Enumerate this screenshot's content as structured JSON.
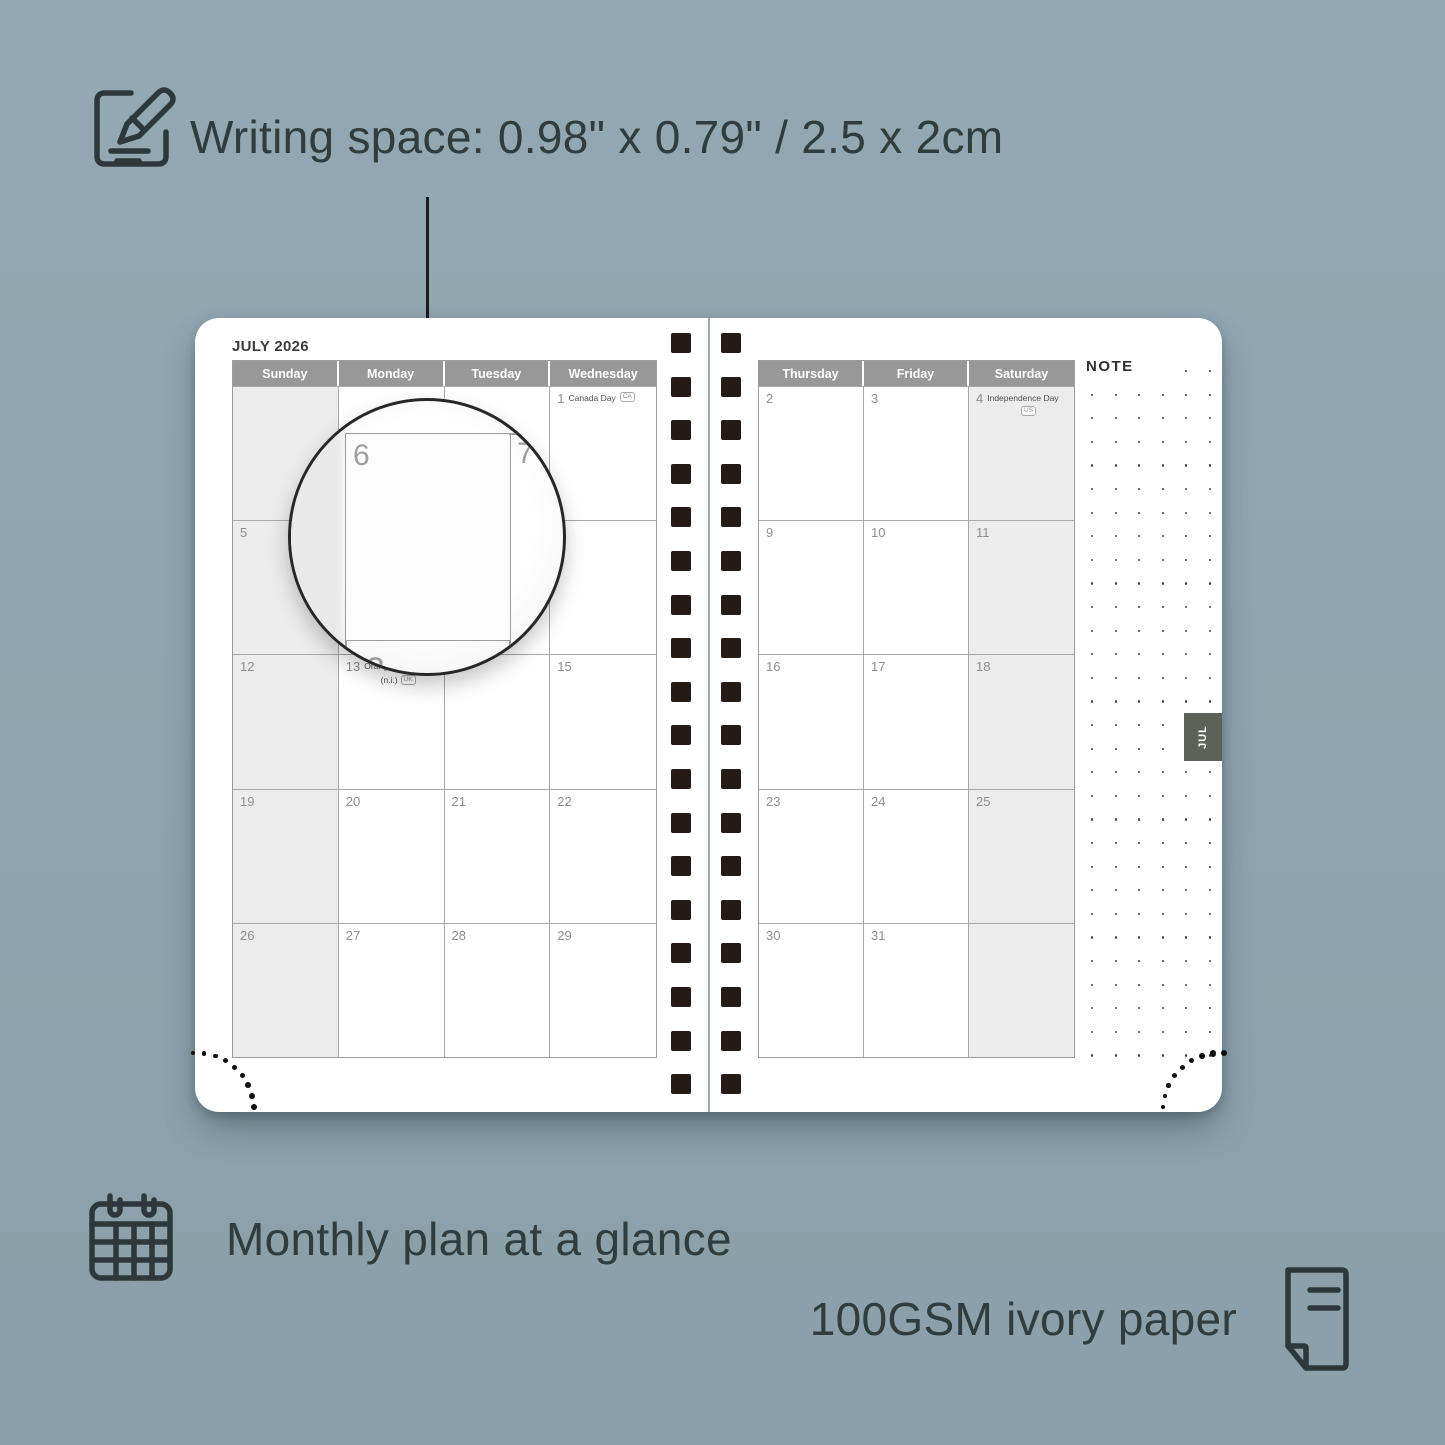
{
  "annotations": {
    "writing_space": "Writing space: 0.98\" x 0.79\" / 2.5 x 2cm",
    "monthly_plan": "Monthly plan at a glance",
    "paper": "100GSM ivory paper"
  },
  "planner": {
    "title": "JULY 2026",
    "note_label": "NOTE",
    "month_tab": "JUL",
    "left_headers": [
      "Sunday",
      "Monday",
      "Tuesday",
      "Wednesday"
    ],
    "right_headers": [
      "Thursday",
      "Friday",
      "Saturday"
    ],
    "left_rows": [
      [
        {
          "shaded": true
        },
        {},
        {},
        {
          "day": "1",
          "holiday": "Canada Day",
          "badge": "CA",
          "badge_inline": true
        }
      ],
      [
        {
          "day": "5",
          "shaded": true
        },
        {
          "day": "6"
        },
        {
          "day": "7"
        },
        {
          "day": "8"
        }
      ],
      [
        {
          "day": "12",
          "shaded": true
        },
        {
          "day": "13",
          "holiday": "Orangemen's Day",
          "holiday2": "(n.i.)",
          "badge": "UK"
        },
        {
          "day": "14"
        },
        {
          "day": "15"
        }
      ],
      [
        {
          "day": "19",
          "shaded": true
        },
        {
          "day": "20"
        },
        {
          "day": "21"
        },
        {
          "day": "22"
        }
      ],
      [
        {
          "day": "26",
          "shaded": true
        },
        {
          "day": "27"
        },
        {
          "day": "28"
        },
        {
          "day": "29"
        }
      ]
    ],
    "right_rows": [
      [
        {
          "day": "2"
        },
        {
          "day": "3"
        },
        {
          "day": "4",
          "holiday": "Independence Day",
          "badge": "US",
          "shaded": true
        }
      ],
      [
        {
          "day": "9"
        },
        {
          "day": "10"
        },
        {
          "day": "11",
          "shaded": true
        }
      ],
      [
        {
          "day": "16"
        },
        {
          "day": "17"
        },
        {
          "day": "18",
          "shaded": true
        }
      ],
      [
        {
          "day": "23"
        },
        {
          "day": "24"
        },
        {
          "day": "25",
          "shaded": true
        }
      ],
      [
        {
          "day": "30"
        },
        {
          "day": "31"
        },
        {
          "shaded": true
        }
      ]
    ],
    "magnifier": {
      "day_left": "6",
      "day_right": "7",
      "day_bottom": "13"
    }
  },
  "colors": {
    "background": "#8fa4ae",
    "ink": "#313c3e",
    "header_bg": "#989898",
    "shaded_cell": "#ececec",
    "tab_bg": "#5d6158",
    "spiral": "#241b17",
    "circle_border": "#272727"
  }
}
